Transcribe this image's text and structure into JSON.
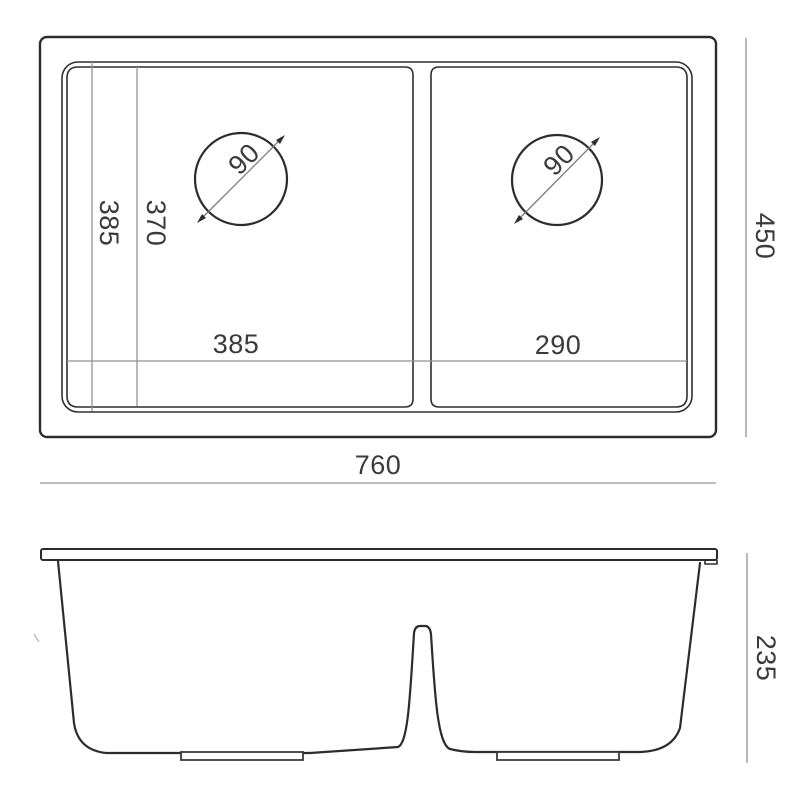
{
  "document": {
    "type": "technical-dimension-drawing",
    "subject": "double-bowl undermount kitchen sink",
    "background_color": "#ffffff"
  },
  "colors": {
    "outline": "#2c2c2c",
    "rim_line": "#2e2e2e",
    "dimension_line": "#929292",
    "label_text": "#3a3a3a"
  },
  "top_view": {
    "description": "plan view of sink with two bowls and drain holes",
    "labels": {
      "bowl_length_outer": "385",
      "bowl_length_inner": "370",
      "drain_left_diameter": "90",
      "drain_right_diameter": "90",
      "left_bowl_width": "385",
      "right_bowl_width": "290",
      "overall_width": "760",
      "overall_depth": "450"
    }
  },
  "front_view": {
    "description": "front elevation of sink showing bowl depth profile",
    "labels": {
      "overall_height": "235"
    }
  }
}
